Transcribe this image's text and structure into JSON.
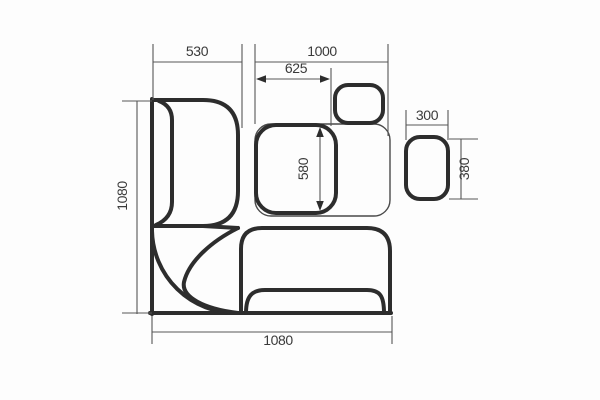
{
  "style": {
    "background": "#fdfdfd",
    "thick_stroke_color": "#2d2d2d",
    "thin_stroke_color": "#4a4a4a",
    "dim_line_color": "#565656",
    "label_color": "#3a3a3a",
    "thick_width": 4,
    "thin_width": 1.4,
    "dim_width": 1.1,
    "label_font_size": 14
  },
  "canvas": {
    "width": 600,
    "height": 400
  },
  "drawing": {
    "shapes": [
      {
        "name": "outer-left-edge",
        "type": "path",
        "thick": true,
        "d": "M152,99 L152,314"
      },
      {
        "name": "outer-bottom-edge",
        "type": "path",
        "thick": true,
        "d": "M150,313 L391,313"
      },
      {
        "name": "bench-left-outer",
        "type": "path",
        "thick": true,
        "d": "M152,100 L203,100 Q238,100 238,135 L238,191 Q238,226 203,226 L152,226"
      },
      {
        "name": "bench-left-backrest",
        "type": "path",
        "thick": true,
        "d": "M159,101 Q172,106 172,120 L172,202 Q172,218 156,225"
      },
      {
        "name": "corner-top-edge",
        "type": "path",
        "thick": true,
        "d": "M203,226 L238,228"
      },
      {
        "name": "corner-seat-arc",
        "type": "path",
        "thick": true,
        "d": "M152,231 A84,84 0 0 0 236,313"
      },
      {
        "name": "corner-leaf-edge",
        "type": "path",
        "thick": true,
        "d": "M238,228 C212,241 189,261 184,282 C181,297 204,309 238,313"
      },
      {
        "name": "bench-bottom-outer",
        "type": "path",
        "thick": true,
        "d": "M241,313 L241,249 Q241,228 262,228 L367,228 Q390,228 390,251 L390,313"
      },
      {
        "name": "bench-bottom-backrest",
        "type": "path",
        "thick": true,
        "d": "M246,313 C246,295 253,290 265,290 L367,290 C380,290 384,296 384,313"
      },
      {
        "name": "table-outline",
        "type": "rect",
        "thick": false,
        "x": 255,
        "y": 124,
        "w": 135,
        "h": 92,
        "rx": 16
      },
      {
        "name": "cushion-middle",
        "type": "rect",
        "thick": true,
        "x": 256,
        "y": 125,
        "w": 80,
        "h": 88,
        "rx": 20
      },
      {
        "name": "cushion-top-small",
        "type": "rect",
        "thick": true,
        "x": 335,
        "y": 85,
        "w": 48,
        "h": 38,
        "rx": 13
      },
      {
        "name": "stool-right",
        "type": "rect",
        "thick": true,
        "x": 406,
        "y": 137,
        "w": 42,
        "h": 62,
        "rx": 14
      }
    ]
  },
  "dimensions": [
    {
      "name": "dim-530",
      "label": "530",
      "label_x": 197,
      "label_y": 56,
      "rotate": 0,
      "lines": [
        [
          153,
          62,
          242,
          62
        ],
        [
          153,
          44,
          153,
          100
        ],
        [
          242,
          44,
          242,
          128
        ]
      ],
      "arrows": []
    },
    {
      "name": "dim-1000",
      "label": "1000",
      "label_x": 322,
      "label_y": 56,
      "rotate": 0,
      "lines": [
        [
          255,
          62,
          388,
          62
        ],
        [
          255,
          44,
          255,
          124
        ],
        [
          388,
          44,
          388,
          136
        ]
      ],
      "arrows": []
    },
    {
      "name": "dim-625",
      "label": "625",
      "label_x": 296,
      "label_y": 73,
      "rotate": 0,
      "lines": [
        [
          258,
          79,
          328,
          79
        ],
        [
          331,
          68,
          331,
          126
        ]
      ],
      "arrows": [
        [
          256,
          79,
          "left"
        ],
        [
          330,
          79,
          "right"
        ]
      ]
    },
    {
      "name": "dim-580",
      "label": "580",
      "label_x": 308,
      "label_y": 169,
      "rotate": -90,
      "lines": [
        [
          320,
          131,
          320,
          207
        ]
      ],
      "arrows": [
        [
          320,
          127,
          "up"
        ],
        [
          320,
          211,
          "down"
        ]
      ]
    },
    {
      "name": "dim-1080-left",
      "label": "1080",
      "label_x": 127,
      "label_y": 196,
      "rotate": -90,
      "lines": [
        [
          137,
          101,
          137,
          314
        ],
        [
          122,
          101,
          152,
          101
        ],
        [
          122,
          313,
          152,
          313
        ]
      ],
      "arrows": []
    },
    {
      "name": "dim-1080-bottom",
      "label": "1080",
      "label_x": 278,
      "label_y": 345,
      "rotate": 0,
      "lines": [
        [
          152,
          332,
          392,
          332
        ],
        [
          152,
          316,
          152,
          344
        ],
        [
          392,
          316,
          392,
          344
        ]
      ],
      "arrows": []
    },
    {
      "name": "dim-300",
      "label": "300",
      "label_x": 427,
      "label_y": 120,
      "rotate": 0,
      "lines": [
        [
          406,
          125,
          448,
          125
        ],
        [
          406,
          110,
          406,
          140
        ],
        [
          448,
          110,
          448,
          140
        ]
      ],
      "arrows": []
    },
    {
      "name": "dim-380",
      "label": "380",
      "label_x": 469,
      "label_y": 169,
      "rotate": -90,
      "lines": [
        [
          461,
          139,
          461,
          199
        ],
        [
          449,
          139,
          478,
          139
        ],
        [
          449,
          199,
          478,
          199
        ]
      ],
      "arrows": []
    }
  ]
}
